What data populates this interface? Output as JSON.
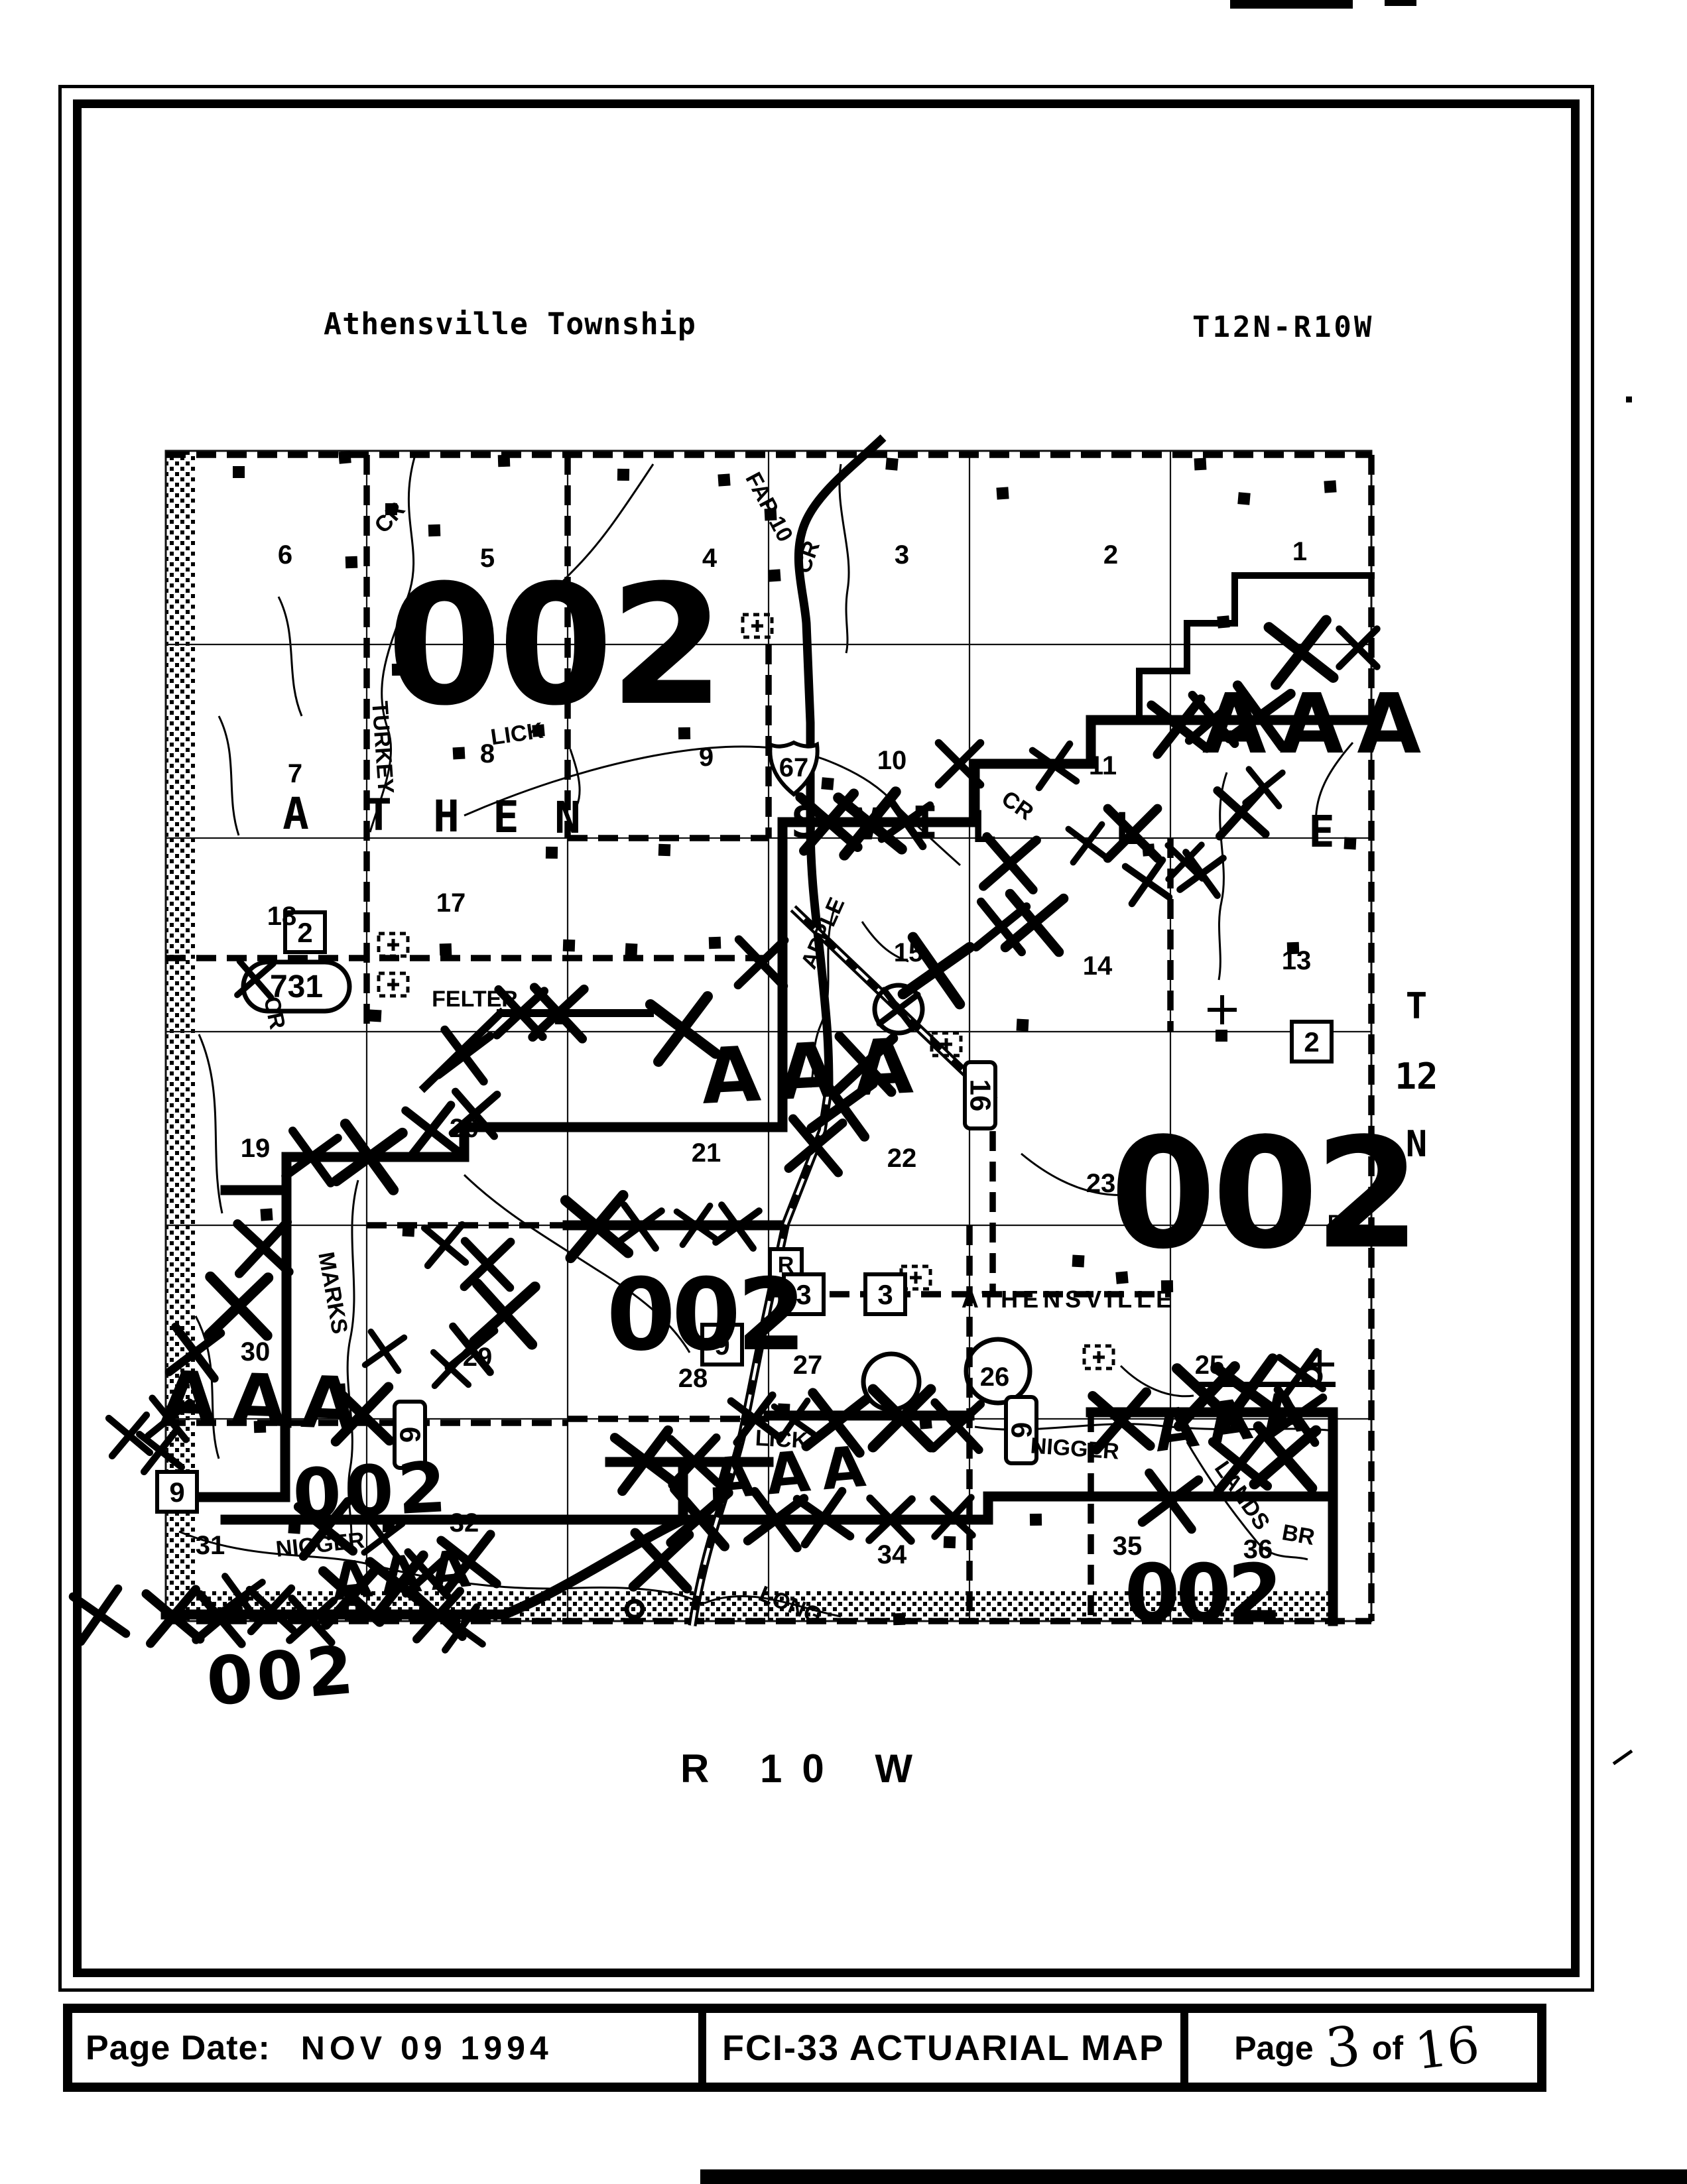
{
  "header": {
    "title": "Athensville Township",
    "range": "T12N-R10W"
  },
  "footer": {
    "page_date_label": "Page Date:",
    "page_date_value": "NOV 09 1994",
    "map_title": "FCI-33 ACTUARIAL MAP",
    "page_label": "Page",
    "page_number": "3",
    "of_label": "of",
    "page_total": "16"
  },
  "map": {
    "town_label": "ATHENSVILLE",
    "range_label_bottom": "R 10 W",
    "township_label_right": [
      "T",
      "12",
      "N"
    ],
    "township_letters": [
      [
        "A",
        446,
        1250
      ],
      [
        "T",
        571,
        1252
      ],
      [
        "H",
        673,
        1254
      ],
      [
        "E",
        763,
        1255
      ],
      [
        "N",
        856,
        1256
      ],
      [
        "S",
        1213,
        1263
      ],
      [
        "V",
        1308,
        1266
      ],
      [
        "I",
        1395,
        1263
      ],
      [
        "L",
        1483,
        1270
      ],
      [
        "L",
        1700,
        1273
      ],
      [
        "E",
        1993,
        1277
      ]
    ],
    "sections": [
      [
        "6",
        430,
        850
      ],
      [
        "5",
        735,
        855
      ],
      [
        "4",
        1070,
        855
      ],
      [
        "3",
        1360,
        850
      ],
      [
        "2",
        1675,
        850
      ],
      [
        "1",
        1960,
        845
      ],
      [
        "7",
        445,
        1180
      ],
      [
        "8",
        735,
        1150
      ],
      [
        "9",
        1065,
        1155
      ],
      [
        "10",
        1345,
        1160
      ],
      [
        "11",
        1663,
        1168
      ],
      [
        "18",
        425,
        1395
      ],
      [
        "17",
        680,
        1375
      ],
      [
        "15",
        1370,
        1450
      ],
      [
        "14",
        1655,
        1470
      ],
      [
        "13",
        1955,
        1462
      ],
      [
        "19",
        385,
        1745
      ],
      [
        "20",
        700,
        1715
      ],
      [
        "21",
        1065,
        1752
      ],
      [
        "22",
        1360,
        1760
      ],
      [
        "23",
        1660,
        1798
      ],
      [
        "30",
        385,
        2052
      ],
      [
        "29",
        720,
        2060
      ],
      [
        "28",
        1045,
        2092
      ],
      [
        "27",
        1218,
        2072
      ],
      [
        "26",
        1500,
        2090
      ],
      [
        "25",
        1824,
        2072
      ],
      [
        "31",
        317,
        2344
      ],
      [
        "32",
        700,
        2310
      ],
      [
        "34",
        1345,
        2358
      ],
      [
        "35",
        1700,
        2345
      ],
      [
        "36",
        1897,
        2350
      ]
    ],
    "zone_text": "002",
    "zone_labels": [
      [
        "002",
        835,
        1060,
        250,
        "print",
        0
      ],
      [
        "002",
        1905,
        1880,
        230,
        "print",
        0
      ],
      [
        "002",
        1062,
        2035,
        150,
        "print",
        0
      ],
      [
        "002",
        1812,
        2445,
        120,
        "print",
        0
      ],
      [
        "002",
        562,
        2285,
        105,
        "hand",
        -3
      ],
      [
        "002",
        428,
        2562,
        100,
        "hand",
        -5
      ]
    ],
    "aaa_text": "AAA",
    "aaa_labels": [
      [
        1988,
        1135,
        125,
        20,
        0
      ],
      [
        1232,
        1655,
        115,
        26,
        -3
      ],
      [
        400,
        2150,
        108,
        22,
        2
      ],
      [
        1200,
        2250,
        85,
        18,
        -5
      ],
      [
        1866,
        2172,
        85,
        16,
        -8
      ],
      [
        614,
        2402,
        78,
        14,
        -6
      ]
    ],
    "creek_labels": [
      [
        "FAP 10",
        1150,
        770,
        62,
        40
      ],
      [
        "TURKEY",
        566,
        1128,
        86,
        34
      ],
      [
        "CR",
        596,
        788,
        -48,
        32
      ],
      [
        "CR",
        1228,
        844,
        -70,
        32
      ],
      [
        "LICK",
        781,
        1118,
        -8,
        36
      ],
      [
        "CR",
        1528,
        1224,
        35,
        30
      ],
      [
        "CR",
        403,
        1530,
        78,
        30
      ],
      [
        "APPLE",
        1251,
        1412,
        -66,
        34
      ],
      [
        "FELTER",
        716,
        1518,
        0,
        40
      ],
      [
        "MARKS",
        491,
        1952,
        80,
        34
      ],
      [
        "NIGGER",
        1620,
        2196,
        4,
        34
      ],
      [
        "NIGGER",
        484,
        2341,
        -6,
        34
      ],
      [
        "LONG",
        1188,
        2431,
        22,
        38
      ],
      [
        "LANDS",
        1864,
        2262,
        55,
        32
      ],
      [
        "BR",
        1956,
        2326,
        10,
        30
      ],
      [
        "LICK",
        1178,
        2182,
        3,
        32
      ],
      [
        "B",
        2014,
        1856,
        0,
        30
      ]
    ],
    "route_markers": [
      [
        "shield",
        "67",
        1197,
        1158
      ],
      [
        "box",
        "2",
        460,
        1406
      ],
      [
        "oval",
        "731",
        447,
        1488
      ],
      [
        "box",
        "2",
        1978,
        1571
      ],
      [
        "vbox",
        "16",
        1478,
        1652
      ],
      [
        "boxsm",
        "R",
        1185,
        1907
      ],
      [
        "box",
        "3",
        1212,
        1952
      ],
      [
        "box",
        "3",
        1335,
        1952
      ],
      [
        "box",
        "9",
        1089,
        2028
      ],
      [
        "box",
        "9",
        267,
        2250
      ],
      [
        "vbox",
        "6",
        618,
        2164
      ],
      [
        "vbox",
        "6",
        1540,
        2157
      ]
    ],
    "church_markers": [
      [
        1142,
        944
      ],
      [
        593,
        1425
      ],
      [
        593,
        1485
      ],
      [
        1427,
        1575
      ],
      [
        1381,
        1927
      ],
      [
        1657,
        2047
      ]
    ],
    "circles": [
      [
        1355,
        1522,
        36
      ],
      [
        1505,
        2068,
        48
      ],
      [
        1344,
        2084,
        42
      ],
      [
        1978,
        2076,
        13
      ],
      [
        957,
        2427,
        12
      ]
    ],
    "cross_markers": [
      [
        1843,
        1523
      ],
      [
        1990,
        2058
      ]
    ],
    "x_marks": [
      [
        1830,
        1085
      ],
      [
        1900,
        1080
      ],
      [
        1962,
        984
      ],
      [
        2048,
        977
      ],
      [
        1778,
        1096
      ],
      [
        1906,
        1188
      ],
      [
        1872,
        1225
      ],
      [
        1730,
        1330
      ],
      [
        1812,
        1318
      ],
      [
        1250,
        1240
      ],
      [
        1312,
        1242
      ],
      [
        1366,
        1240
      ],
      [
        1447,
        1152
      ],
      [
        1523,
        1302
      ],
      [
        1640,
        1272
      ],
      [
        1708,
        1257
      ],
      [
        1787,
        1300
      ],
      [
        1590,
        1155
      ],
      [
        785,
        1528
      ],
      [
        842,
        1528
      ],
      [
        700,
        1592
      ],
      [
        385,
        1477
      ],
      [
        1148,
        1452
      ],
      [
        1412,
        1464
      ],
      [
        1305,
        1605
      ],
      [
        1270,
        1668
      ],
      [
        1230,
        1728
      ],
      [
        1030,
        1552
      ],
      [
        1560,
        1392
      ],
      [
        1510,
        1398
      ],
      [
        1355,
        1522
      ],
      [
        900,
        1850
      ],
      [
        965,
        1850
      ],
      [
        1050,
        1848
      ],
      [
        1112,
        1850
      ],
      [
        470,
        1745
      ],
      [
        557,
        1745
      ],
      [
        650,
        1705
      ],
      [
        716,
        1680
      ],
      [
        397,
        1882
      ],
      [
        360,
        1970
      ],
      [
        671,
        1878
      ],
      [
        735,
        1907
      ],
      [
        761,
        1982
      ],
      [
        711,
        2035
      ],
      [
        294,
        2040
      ],
      [
        255,
        2140
      ],
      [
        242,
        2188
      ],
      [
        195,
        2165
      ],
      [
        546,
        2133
      ],
      [
        580,
        2038
      ],
      [
        680,
        2064
      ],
      [
        973,
        2203
      ],
      [
        1047,
        2204
      ],
      [
        1138,
        2140
      ],
      [
        1197,
        2142
      ],
      [
        1261,
        2146
      ],
      [
        1055,
        2289
      ],
      [
        1170,
        2292
      ],
      [
        1242,
        2289
      ],
      [
        1343,
        2292
      ],
      [
        1437,
        2288
      ],
      [
        997,
        2354
      ],
      [
        1360,
        2139
      ],
      [
        1443,
        2151
      ],
      [
        261,
        2438
      ],
      [
        333,
        2442
      ],
      [
        363,
        2410
      ],
      [
        409,
        2428
      ],
      [
        470,
        2444
      ],
      [
        491,
        2306
      ],
      [
        530,
        2408
      ],
      [
        578,
        2320
      ],
      [
        603,
        2391
      ],
      [
        645,
        2374
      ],
      [
        661,
        2436
      ],
      [
        695,
        2456
      ],
      [
        707,
        2356
      ],
      [
        150,
        2436
      ],
      [
        1820,
        2106
      ],
      [
        1883,
        2099
      ],
      [
        1962,
        2071
      ],
      [
        1870,
        2208
      ],
      [
        1938,
        2198
      ],
      [
        1765,
        2264
      ],
      [
        1691,
        2143
      ],
      [
        1955,
        2136
      ]
    ],
    "buildings": [
      [
        360,
        712
      ],
      [
        520,
        690
      ],
      [
        590,
        768
      ],
      [
        655,
        800
      ],
      [
        530,
        848
      ],
      [
        760,
        695
      ],
      [
        940,
        716
      ],
      [
        1092,
        724
      ],
      [
        1162,
        776
      ],
      [
        1168,
        868
      ],
      [
        1345,
        700
      ],
      [
        1512,
        744
      ],
      [
        1810,
        700
      ],
      [
        1876,
        752
      ],
      [
        2006,
        734
      ],
      [
        1845,
        938
      ],
      [
        600,
        1010
      ],
      [
        812,
        1102
      ],
      [
        692,
        1136
      ],
      [
        1032,
        1106
      ],
      [
        1248,
        1182
      ],
      [
        832,
        1286
      ],
      [
        1002,
        1282
      ],
      [
        1732,
        1282
      ],
      [
        2036,
        1272
      ],
      [
        672,
        1432
      ],
      [
        858,
        1426
      ],
      [
        952,
        1432
      ],
      [
        1078,
        1422
      ],
      [
        566,
        1532
      ],
      [
        846,
        1536
      ],
      [
        1542,
        1546
      ],
      [
        1842,
        1562
      ],
      [
        402,
        1832
      ],
      [
        616,
        1856
      ],
      [
        512,
        2096
      ],
      [
        392,
        2152
      ],
      [
        1396,
        2146
      ],
      [
        1626,
        1902
      ],
      [
        1692,
        1927
      ],
      [
        1182,
        2126
      ],
      [
        1562,
        2292
      ],
      [
        1432,
        2326
      ],
      [
        1356,
        2442
      ],
      [
        1084,
        2252
      ],
      [
        444,
        2304
      ],
      [
        586,
        2302
      ],
      [
        1950,
        1430
      ],
      [
        1760,
        1940
      ]
    ]
  }
}
